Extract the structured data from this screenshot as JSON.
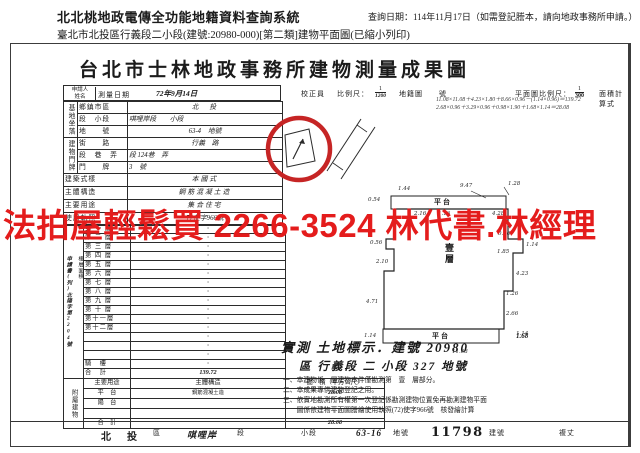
{
  "page": {
    "system_title": "北北桃地政電傳全功能地籍資料查詢系統",
    "query_date": "查詢日期：114年11月17日（如需登記謄本，請向地政事務所申請。）",
    "subtitle": "臺北市北投區行義段二小段(建號:20980-000)[第二類]建物平面圖(已縮小列印)"
  },
  "watermark": {
    "text": "法拍屋輕鬆買  2266-3524  林代書.林經理",
    "color": "#e41c1c"
  },
  "doc": {
    "title": "台北市士林地政事務所建物測量成果圖",
    "top": {
      "applicant": "申請人",
      "name": "姓名",
      "survey_date_label": "測量日期",
      "survey_date": "72年9月14日",
      "checker": "校正員",
      "scale_label": "比例尺：",
      "scale_num": "1",
      "scale_den": "1200",
      "map_label": "地籍圖",
      "no_label": "號",
      "plan_scale_label": "平面圖比例尺：",
      "plan_scale_num": "1",
      "plan_scale_den": "300",
      "formula_label": "面積計算式",
      "formula1": "11.08×11.08＋4.23×1.80＋8.66×0.96－(1.14×0.96)＝139.72",
      "formula2": "2.68×0.96＋3.29×0.96＋0.98×1.90＋1.68×1.14＝28.08"
    },
    "site": {
      "group": "基地坐落",
      "rows": [
        {
          "label": "鄉鎮市區",
          "value": "北　投"
        },
        {
          "label": "段　小段",
          "value": "唭哩岸段　　小段"
        },
        {
          "label": "地　　號",
          "value": "63-4　地號"
        }
      ]
    },
    "door": {
      "group": "建物門牌",
      "rows": [
        {
          "label": "街　　路",
          "value": "行義　路"
        },
        {
          "label": "段　巷　弄",
          "value": "段 124巷　弄"
        },
        {
          "label": "門　　牌",
          "value": "3　號"
        }
      ]
    },
    "info_rows": [
      {
        "label": "建築式樣",
        "value": "本國式"
      },
      {
        "label": "主體構造",
        "value": "鋼筋混凝土造"
      },
      {
        "label": "主要用途",
        "value": "集合住宅"
      },
      {
        "label": "使用執照",
        "value": "72使字966號"
      }
    ],
    "floors": {
      "group": "樓層面積",
      "unit": "（平方公尺）",
      "apply_no": "申請書(列)北陽字第2204號",
      "rows": [
        {
          "label": "第 一 層",
          "value": "·"
        },
        {
          "label": "第 二 層",
          "value": "·"
        },
        {
          "label": "第 三 層",
          "value": "·"
        },
        {
          "label": "第 四 層",
          "value": "·"
        },
        {
          "label": "第 五 層",
          "value": "·"
        },
        {
          "label": "第 六 層",
          "value": "·"
        },
        {
          "label": "第 七 層",
          "value": "·"
        },
        {
          "label": "第 八 層",
          "value": "·"
        },
        {
          "label": "第 九 層",
          "value": "·"
        },
        {
          "label": "第 十 層",
          "value": "·"
        },
        {
          "label": "第十一層",
          "value": "·"
        },
        {
          "label": "第十二層",
          "value": "·"
        },
        {
          "label": "",
          "value": "·"
        },
        {
          "label": "",
          "value": "·"
        },
        {
          "label": "",
          "value": "·"
        },
        {
          "label": "騎　樓",
          "value": "·"
        },
        {
          "label": "合　計",
          "value": "139.72"
        }
      ]
    },
    "attached": {
      "group": "附屬建物",
      "header": {
        "use": "主要用途",
        "structure": "主體構造",
        "area": "面　積（平方公尺）"
      },
      "rows": [
        {
          "use": "平　台",
          "structure": "鋼筋混凝土造",
          "area": "28.08"
        },
        {
          "use": "陽　台",
          "structure": "",
          "area": "·"
        },
        {
          "use": "",
          "structure": "",
          "area": "·"
        },
        {
          "use": "合　計",
          "structure": "",
          "area": "28.08"
        }
      ]
    },
    "plan": {
      "floor_label": "壹層",
      "platform_top": "平台",
      "platform_bottom": "平台",
      "dims": [
        "0.54",
        "1.44",
        "9.47",
        "1.28",
        "2.16",
        "1.16",
        "4.28",
        "0.56",
        "2.10",
        "4.71",
        "0.96",
        "1.85",
        "1.14",
        "4.23",
        "1.26",
        "2.66",
        "1.14",
        "1.14",
        "11.68"
      ]
    },
    "survey_line": "實測 土地標示．建號 20980",
    "survey_sup": "1.68",
    "parcel_line": "區 行義段 二 小段 327 地號",
    "notes": [
      "一、本建物係　層建物本件僅勘測第　壹　層部分。",
      "二、本成果專供建物登記之用。",
      "三、依實地勘測所有權第一次登記係勘測建物位置免再勘測建物平面",
      "　　圖係依建物平面圖謄繪使用執照(72)使字966號　核發繪計算"
    ],
    "bottom": {
      "district": "北　投",
      "district_suffix": "區",
      "section": "唭哩岸",
      "section_suffix": "段",
      "subsection_label": "小段",
      "parcel": "63-16",
      "parcel_suffix": "地號",
      "building_no": "11798",
      "building_suffix": "建號",
      "remeasure": "複丈"
    }
  }
}
